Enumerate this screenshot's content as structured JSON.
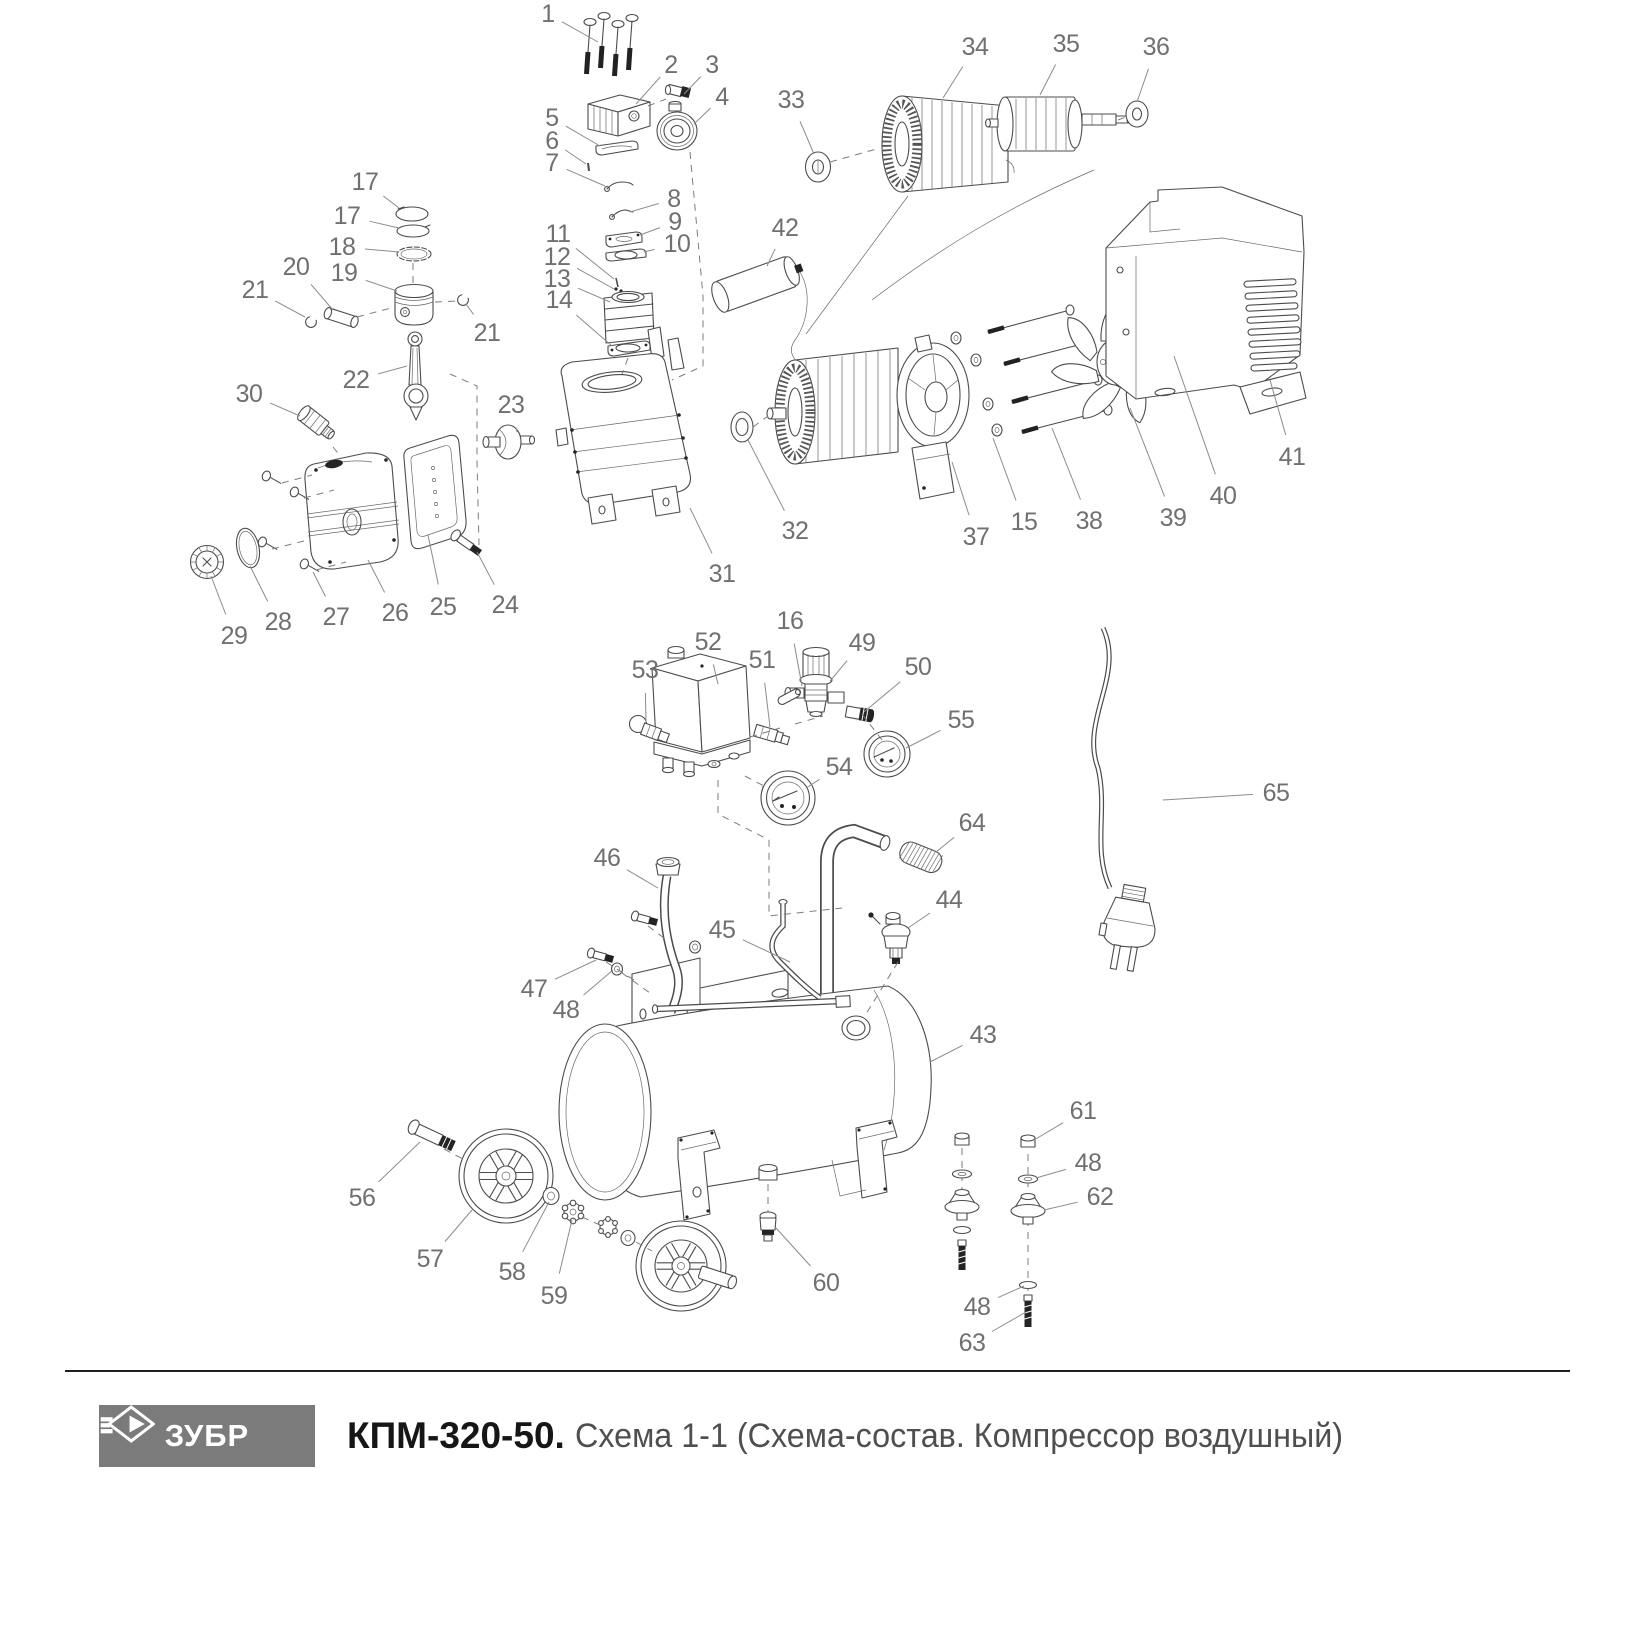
{
  "footer": {
    "brand": "ЗУБР",
    "model": "КПМ-320-50.",
    "subtitle": "Схема 1-1 (Схема-состав. Компрессор воздушный)",
    "logo_bg": "#7b7b7b",
    "logo_text_color": "#ffffff"
  },
  "diagram": {
    "line_color": "#4c4c4c",
    "label_color": "#707070",
    "leader_color": "#8c8c8c",
    "callouts": [
      {
        "n": "1",
        "x": 548,
        "y": 14,
        "tx": 598,
        "ty": 42
      },
      {
        "n": "2",
        "x": 671,
        "y": 65,
        "tx": 636,
        "ty": 104
      },
      {
        "n": "3",
        "x": 712,
        "y": 65,
        "tx": 684,
        "ty": 94
      },
      {
        "n": "4",
        "x": 722,
        "y": 97,
        "tx": 694,
        "ty": 124
      },
      {
        "n": "5",
        "x": 552,
        "y": 118,
        "tx": 600,
        "ty": 146
      },
      {
        "n": "6",
        "x": 552,
        "y": 141,
        "tx": 586,
        "ty": 164
      },
      {
        "n": "7",
        "x": 552,
        "y": 163,
        "tx": 605,
        "ty": 186
      },
      {
        "n": "8",
        "x": 674,
        "y": 199,
        "tx": 630,
        "ty": 212
      },
      {
        "n": "9",
        "x": 675,
        "y": 222,
        "tx": 640,
        "ty": 235
      },
      {
        "n": "10",
        "x": 677,
        "y": 244,
        "tx": 644,
        "ty": 252
      },
      {
        "n": "11",
        "x": 558,
        "y": 234,
        "tx": 614,
        "ty": 279
      },
      {
        "n": "12",
        "x": 557,
        "y": 257,
        "tx": 614,
        "ty": 289
      },
      {
        "n": "13",
        "x": 557,
        "y": 279,
        "tx": 610,
        "ty": 302
      },
      {
        "n": "14",
        "x": 559,
        "y": 300,
        "tx": 612,
        "ty": 346
      },
      {
        "n": "17",
        "x": 365,
        "y": 182,
        "tx": 399,
        "ty": 208
      },
      {
        "n": "17",
        "x": 347,
        "y": 216,
        "tx": 399,
        "ty": 228
      },
      {
        "n": "18",
        "x": 342,
        "y": 247,
        "tx": 399,
        "ty": 252
      },
      {
        "n": "19",
        "x": 344,
        "y": 273,
        "tx": 397,
        "ty": 291
      },
      {
        "n": "20",
        "x": 296,
        "y": 267,
        "tx": 333,
        "ty": 310
      },
      {
        "n": "21",
        "x": 255,
        "y": 290,
        "tx": 305,
        "ty": 317
      },
      {
        "n": "21",
        "x": 487,
        "y": 333,
        "tx": 466,
        "ty": 304
      },
      {
        "n": "22",
        "x": 356,
        "y": 380,
        "tx": 407,
        "ty": 366
      },
      {
        "n": "23",
        "x": 511,
        "y": 405,
        "tx": 517,
        "ty": 432
      },
      {
        "n": "24",
        "x": 505,
        "y": 605,
        "tx": 477,
        "ty": 552
      },
      {
        "n": "25",
        "x": 443,
        "y": 607,
        "tx": 428,
        "ty": 535
      },
      {
        "n": "26",
        "x": 395,
        "y": 613,
        "tx": 368,
        "ty": 560
      },
      {
        "n": "27",
        "x": 336,
        "y": 617,
        "tx": 313,
        "ty": 572
      },
      {
        "n": "28",
        "x": 278,
        "y": 622,
        "tx": 250,
        "ty": 566
      },
      {
        "n": "29",
        "x": 234,
        "y": 636,
        "tx": 211,
        "ty": 576
      },
      {
        "n": "30",
        "x": 249,
        "y": 394,
        "tx": 300,
        "ty": 416
      },
      {
        "n": "31",
        "x": 722,
        "y": 574,
        "tx": 690,
        "ty": 508
      },
      {
        "n": "32",
        "x": 795,
        "y": 531,
        "tx": 748,
        "ty": 440
      },
      {
        "n": "33",
        "x": 791,
        "y": 100,
        "tx": 814,
        "ty": 154
      },
      {
        "n": "34",
        "x": 975,
        "y": 47,
        "tx": 943,
        "ty": 98
      },
      {
        "n": "35",
        "x": 1066,
        "y": 44,
        "tx": 1040,
        "ty": 95
      },
      {
        "n": "36",
        "x": 1156,
        "y": 47,
        "tx": 1137,
        "ty": 102
      },
      {
        "n": "37",
        "x": 976,
        "y": 537,
        "tx": 952,
        "ty": 462
      },
      {
        "n": "15",
        "x": 1024,
        "y": 522,
        "tx": 993,
        "ty": 438
      },
      {
        "n": "38",
        "x": 1089,
        "y": 521,
        "tx": 1052,
        "ty": 428
      },
      {
        "n": "39",
        "x": 1173,
        "y": 518,
        "tx": 1130,
        "ty": 408
      },
      {
        "n": "40",
        "x": 1223,
        "y": 496,
        "tx": 1174,
        "ty": 356
      },
      {
        "n": "41",
        "x": 1292,
        "y": 457,
        "tx": 1270,
        "ty": 380
      },
      {
        "n": "42",
        "x": 785,
        "y": 228,
        "tx": 767,
        "ty": 266
      },
      {
        "n": "16",
        "x": 790,
        "y": 621,
        "tx": 802,
        "ty": 686
      },
      {
        "n": "49",
        "x": 862,
        "y": 643,
        "tx": 830,
        "ty": 681
      },
      {
        "n": "50",
        "x": 918,
        "y": 667,
        "tx": 864,
        "ty": 712
      },
      {
        "n": "51",
        "x": 762,
        "y": 660,
        "tx": 770,
        "ty": 727
      },
      {
        "n": "52",
        "x": 708,
        "y": 642,
        "tx": 718,
        "ty": 684
      },
      {
        "n": "53",
        "x": 645,
        "y": 670,
        "tx": 646,
        "ty": 722
      },
      {
        "n": "54",
        "x": 839,
        "y": 767,
        "tx": 806,
        "ty": 788
      },
      {
        "n": "55",
        "x": 961,
        "y": 720,
        "tx": 906,
        "ty": 748
      },
      {
        "n": "64",
        "x": 972,
        "y": 823,
        "tx": 936,
        "ty": 852
      },
      {
        "n": "46",
        "x": 607,
        "y": 858,
        "tx": 658,
        "ty": 888
      },
      {
        "n": "45",
        "x": 722,
        "y": 930,
        "tx": 790,
        "ty": 962
      },
      {
        "n": "44",
        "x": 949,
        "y": 900,
        "tx": 908,
        "ty": 928
      },
      {
        "n": "43",
        "x": 983,
        "y": 1035,
        "tx": 930,
        "ty": 1062
      },
      {
        "n": "47",
        "x": 534,
        "y": 989,
        "tx": 596,
        "ty": 960
      },
      {
        "n": "48",
        "x": 566,
        "y": 1010,
        "tx": 613,
        "ty": 970
      },
      {
        "n": "56",
        "x": 362,
        "y": 1198,
        "tx": 420,
        "ty": 1142
      },
      {
        "n": "57",
        "x": 430,
        "y": 1259,
        "tx": 472,
        "ty": 1210
      },
      {
        "n": "58",
        "x": 512,
        "y": 1272,
        "tx": 549,
        "ty": 1202
      },
      {
        "n": "59",
        "x": 554,
        "y": 1296,
        "tx": 572,
        "ty": 1220
      },
      {
        "n": "60",
        "x": 826,
        "y": 1283,
        "tx": 776,
        "ty": 1228
      },
      {
        "n": "61",
        "x": 1083,
        "y": 1111,
        "tx": 1034,
        "ty": 1140
      },
      {
        "n": "48",
        "x": 1088,
        "y": 1163,
        "tx": 1036,
        "ty": 1178
      },
      {
        "n": "62",
        "x": 1100,
        "y": 1197,
        "tx": 1044,
        "ty": 1210
      },
      {
        "n": "48",
        "x": 977,
        "y": 1307,
        "tx": 1024,
        "ty": 1286
      },
      {
        "n": "63",
        "x": 972,
        "y": 1343,
        "tx": 1026,
        "ty": 1312
      },
      {
        "n": "65",
        "x": 1276,
        "y": 793,
        "tx": 1163,
        "ty": 800
      }
    ]
  }
}
